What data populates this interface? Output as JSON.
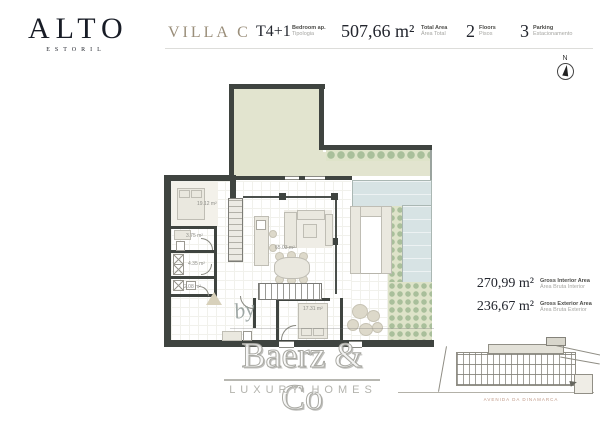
{
  "brand": {
    "name": "ALTO",
    "location": "ESTORIL"
  },
  "header": {
    "villa_name": "VILLA C",
    "specs": [
      {
        "value": "T4+1",
        "label_en": "Bedroom ap.",
        "label_pt": "Tipologia"
      },
      {
        "value": "507,66 m²",
        "label_en": "Total Area",
        "label_pt": "Área Total"
      },
      {
        "value": "2",
        "label_en": "Floors",
        "label_pt": "Pisos"
      },
      {
        "value": "3",
        "label_en": "Parking",
        "label_pt": "Estacionamento"
      }
    ]
  },
  "compass": {
    "north": "N"
  },
  "floorplan": {
    "room_areas": [
      {
        "room": "bedroom-upper",
        "area": "19.12 m²"
      },
      {
        "room": "bathroom",
        "area": "3.75 m²"
      },
      {
        "room": "closet",
        "area": "4.35 m²"
      },
      {
        "room": "wc",
        "area": "2.08 m²"
      },
      {
        "room": "living-kitchen",
        "area": "65.03 m²"
      },
      {
        "room": "bedroom-lower",
        "area": "17.31 m²"
      }
    ]
  },
  "area_summary": [
    {
      "value": "270,99 m²",
      "label_en": "Gross Interior Area",
      "label_pt": "Área Bruta Interior"
    },
    {
      "value": "236,67 m²",
      "label_en": "Gross Exterior Area",
      "label_pt": "Área Bruta Exterior"
    }
  ],
  "watermark": {
    "prefix": "by",
    "name": "Baerz & Co",
    "tagline": "LUXURY HOMES"
  },
  "elevation": {
    "street_label": "AVENIDA DA DINAMARCA"
  },
  "colors": {
    "accent_gold": "#9a8e7a",
    "ink": "#23262e",
    "wall": "#3f4440",
    "garden_green": "#e2e4cf",
    "pool_blue": "#d7e3e4",
    "plant_green": "#a9bf9b",
    "watermark_gray": "#b5b5b0",
    "street_label_pink": "#c09a88"
  }
}
